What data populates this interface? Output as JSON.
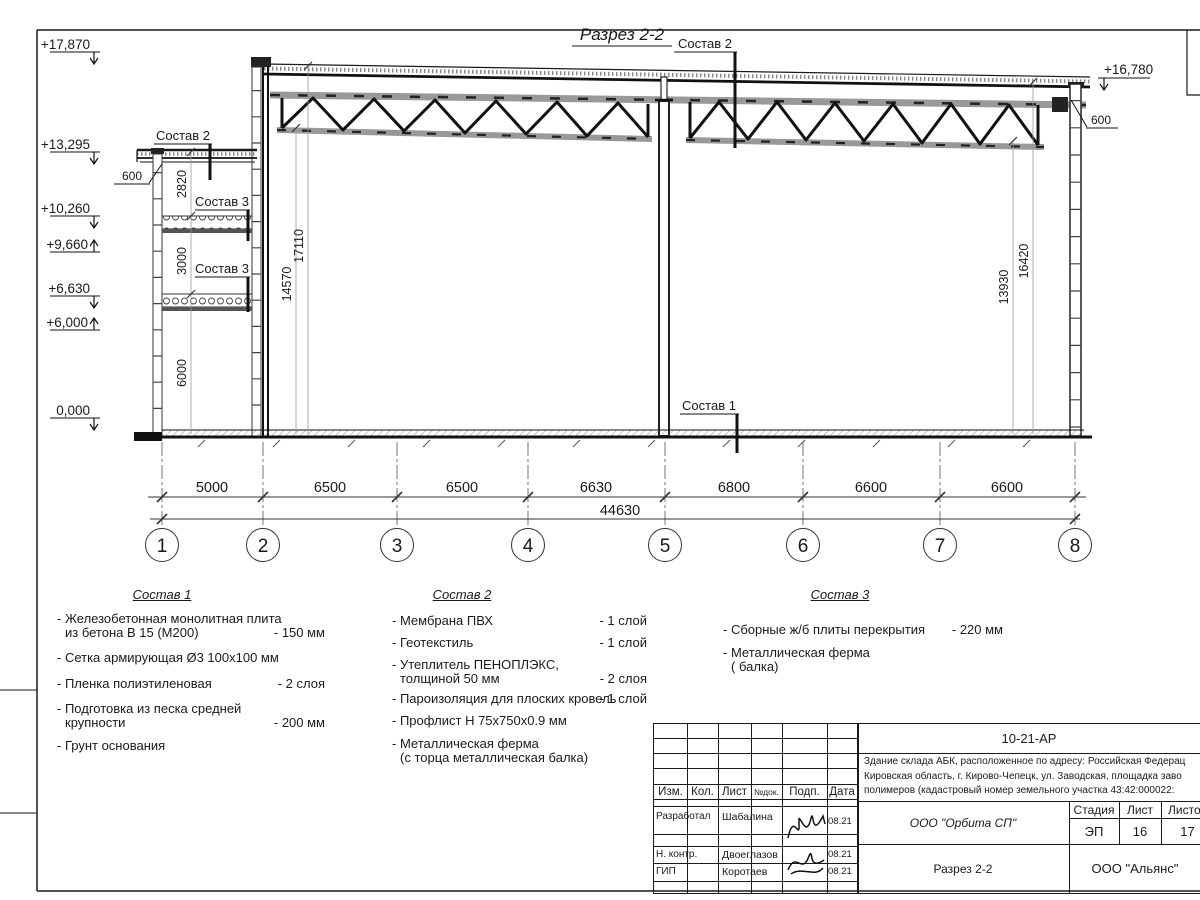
{
  "title": "Разрез 2-2",
  "section": {
    "elevation_marks_left": [
      {
        "value": "+17,870",
        "dir": "down"
      },
      {
        "value": "+13,295",
        "dir": "down"
      },
      {
        "value": "+10,260",
        "dir": "down"
      },
      {
        "value": "+9,660",
        "dir": "up"
      },
      {
        "value": "+6,630",
        "dir": "down"
      },
      {
        "value": "+6,000",
        "dir": "up"
      },
      {
        "value": "0,000",
        "dir": "down"
      }
    ],
    "elevation_mark_right": {
      "value": "+16,780",
      "dir": "down"
    },
    "callouts": {
      "sostav2_roof": "Состав 2",
      "sostav2_annex": "Состав 2",
      "sostav3_upper": "Состав 3",
      "sostav3_lower": "Состав 3",
      "sostav1_floor": "Состав 1",
      "overhang_left": "600",
      "parapet_right": "600"
    },
    "vertical_dims": {
      "annex_1": "2820",
      "annex_2": "3000",
      "annex_3": "6000",
      "left_1": "14570",
      "left_2": "17110",
      "right_1": "13930",
      "right_2": "16420"
    },
    "bottom_dims": [
      "5000",
      "6500",
      "6500",
      "6630",
      "6800",
      "6600",
      "6600"
    ],
    "total_dim": "44630",
    "grid_labels": [
      "1",
      "2",
      "3",
      "4",
      "5",
      "6",
      "7",
      "8"
    ]
  },
  "legends": [
    {
      "title": "Состав 1",
      "items": [
        {
          "l1": "- Железобетонная  монолитная плита",
          "l2": "из бетона В 15 (М200)",
          "value": "- 150 мм"
        },
        {
          "l1": "- Сетка армирующая Ø3 100x100 мм"
        },
        {
          "l1": "- Пленка полиэтиленовая",
          "value": "-  2 слоя"
        },
        {
          "l1": "- Подготовка из песка средней",
          "l2": "крупности",
          "value": "- 200 мм"
        },
        {
          "l1": "- Грунт основания"
        }
      ]
    },
    {
      "title": "Состав 2",
      "items": [
        {
          "l1": "- Мембрана ПВХ",
          "value": "- 1 слой"
        },
        {
          "l1": "- Геотекстиль",
          "value": "- 1 слой"
        },
        {
          "l1": "- Утеплитель ПЕНОПЛЭКС,",
          "l2": "толщиной 50 мм",
          "value": "- 2 слоя"
        },
        {
          "l1": "- Пароизоляция для плоских кровель",
          "value": "- 1 слой"
        },
        {
          "l1": "- Профлист Н 75х750х0.9 мм"
        },
        {
          "l1": "- Металлическая ферма",
          "l2": "(с торца металлическая балка)"
        }
      ]
    },
    {
      "title": "Состав 3",
      "items": [
        {
          "l1": "- Сборные ж/б плиты перекрытия",
          "value": "- 220 мм"
        },
        {
          "l1": "- Металлическая ферма",
          "l2": "( балка)"
        }
      ]
    }
  ],
  "title_block": {
    "doc_number": "10-21-АР",
    "description_lines": [
      "Здание склада АБК, расположенное по адресу: Российская Федерац",
      "Кировская область, г. Кирово-Чепецк, ул. Заводская, площадка заво",
      "полимеров (кадастровый номер земельного участка 43:42:000022:"
    ],
    "columns": [
      "Изм.",
      "Кол.",
      "Лист",
      "№док.",
      "Подп.",
      "Дата"
    ],
    "rows": [
      {
        "role": "Разработал",
        "name": "Шабалина",
        "date": "08.21"
      },
      {
        "role": "Н. контр.",
        "name": "Двоеглазов",
        "date": "08.21"
      },
      {
        "role": "ГИП",
        "name": "Коротаев",
        "date": "08.21"
      }
    ],
    "company": "ООО \"Орбита СП\"",
    "stage_label": "Стадия",
    "sheet_label": "Лист",
    "sheets_label": "Листов",
    "stage": "ЭП",
    "sheet": "16",
    "sheets": "17",
    "drawing_name": "Разрез 2-2",
    "firm": "ООО \"Альянс\""
  }
}
